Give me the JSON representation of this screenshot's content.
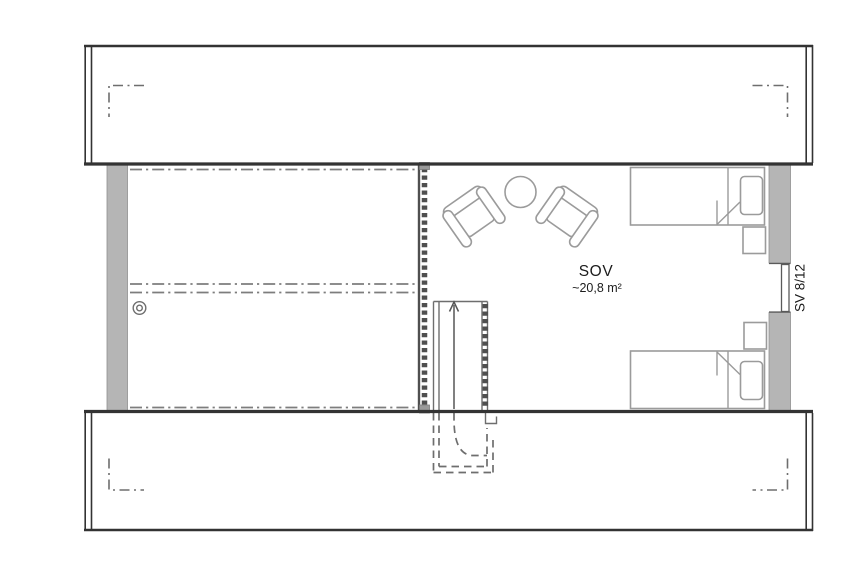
{
  "floorplan": {
    "room": {
      "name": "SOV",
      "area_label": "~20,8 m²"
    },
    "window": {
      "label": "SV 8/12"
    },
    "stair": {
      "direction_icon": "up-arrow"
    }
  },
  "colors": {
    "background": "#ffffff",
    "wall_fill": "#b5b5b5",
    "line_dark": "#333333",
    "line_mid": "#6e6e6e",
    "line_light": "#7d7d7d",
    "furniture": "#9b9b9b",
    "railing": "#4f4f4f",
    "text": "#1c1c1c"
  }
}
